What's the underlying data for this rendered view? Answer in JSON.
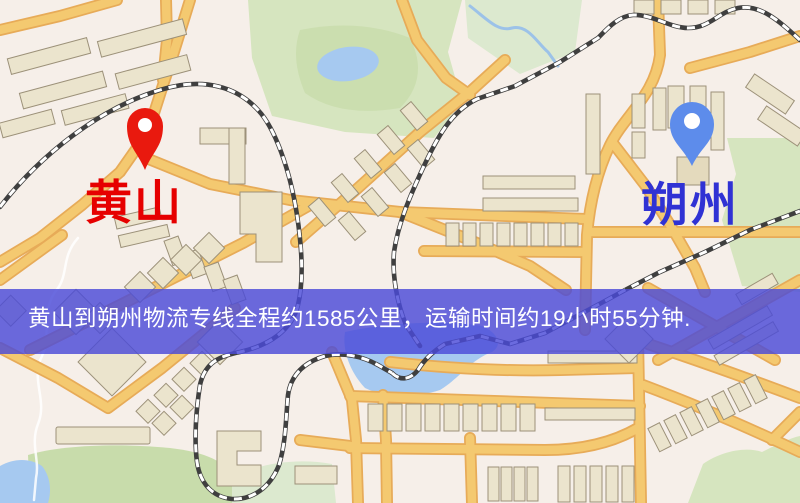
{
  "banner": {
    "text": "黄山到朔州物流专线全程约1585公里，运输时间约19小时55分钟.",
    "background": "rgba(74,74,216,0.82)",
    "text_color": "#ffffff"
  },
  "markers": [
    {
      "id": "origin",
      "label": "黄山",
      "pin_color": "#e9190e",
      "label_color": "#e60000"
    },
    {
      "id": "destination",
      "label": "朔州",
      "pin_color": "#5d8ceb",
      "label_color": "#3032d4"
    }
  ],
  "route": {
    "distance_km": "1585",
    "duration": "19小时55分钟"
  },
  "map_colors": {
    "background": "#f6efe9",
    "road_fill": "#f4c970",
    "road_edge": "#e7ab58",
    "building": "#ebe4cd",
    "green": "#d6e5bf",
    "water": "#a6c9f0",
    "railway": "#3f3f3f"
  }
}
